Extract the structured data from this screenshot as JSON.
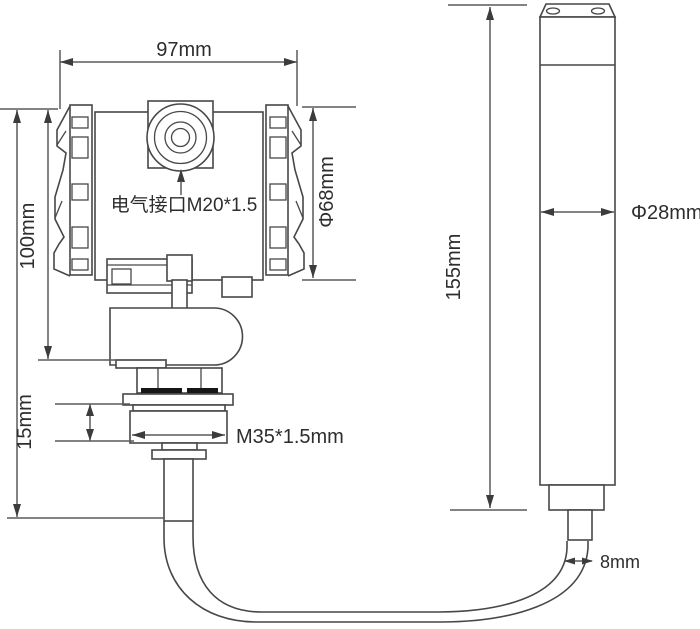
{
  "meta": {
    "type": "technical-dimension-drawing",
    "subject": "submersible level transmitter with probe and cable",
    "background_color": "#ffffff",
    "line_color": "#474747",
    "dimension_line_color": "#5a5a5a",
    "text_color": "#2d2d2d"
  },
  "labels": {
    "housing_width": "97mm",
    "housing_height": "100mm",
    "housing_diameter": "Φ68mm",
    "electrical_interface": "电气接口M20*1.5",
    "gland_height": "15mm",
    "thread_spec": "M35*1.5mm",
    "probe_length": "155mm",
    "probe_diameter": "Φ28mm",
    "cable_diameter": "8mm"
  }
}
